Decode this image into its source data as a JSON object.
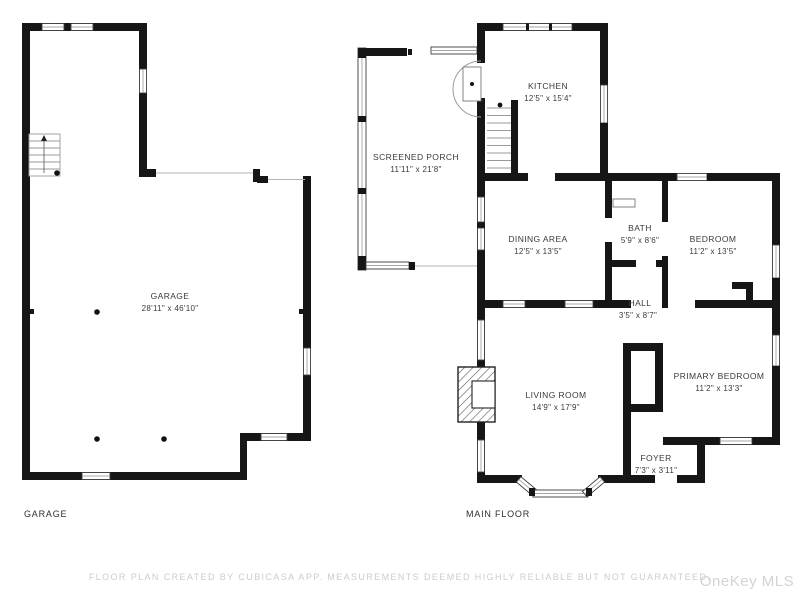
{
  "colors": {
    "wall": "#161616",
    "window_stroke": "#3c3c3c",
    "label_text": "#3a3a3a",
    "muted_text": "#cccccc",
    "watermark_text": "#d3d3d3"
  },
  "floors": [
    {
      "id": "garage",
      "label": "GARAGE"
    },
    {
      "id": "main",
      "label": "MAIN FLOOR"
    }
  ],
  "rooms": {
    "garage": {
      "name": "GARAGE",
      "dims": "28'11\" x 46'10\""
    },
    "screened_porch": {
      "name": "SCREENED PORCH",
      "dims": "11'11\" x 21'8\""
    },
    "kitchen": {
      "name": "KITCHEN",
      "dims": "12'5\" x 15'4\""
    },
    "dining": {
      "name": "DINING AREA",
      "dims": "12'5\" x 13'5\""
    },
    "bath": {
      "name": "BATH",
      "dims": "5'9\" x 8'6\""
    },
    "bedroom": {
      "name": "BEDROOM",
      "dims": "11'2\" x 13'5\""
    },
    "hall": {
      "name": "HALL",
      "dims": "3'5\" x 8'7\""
    },
    "living": {
      "name": "LIVING ROOM",
      "dims": "14'9\" x 17'9\""
    },
    "primary": {
      "name": "PRIMARY BEDROOM",
      "dims": "11'2\" x 13'3\""
    },
    "foyer": {
      "name": "FOYER",
      "dims": "7'3\" x 3'11\""
    }
  },
  "footer": {
    "disclaimer": "FLOOR PLAN CREATED BY CUBICASA APP. MEASUREMENTS DEEMED HIGHLY RELIABLE BUT NOT GUARANTEED.",
    "watermark": "OneKey MLS"
  }
}
